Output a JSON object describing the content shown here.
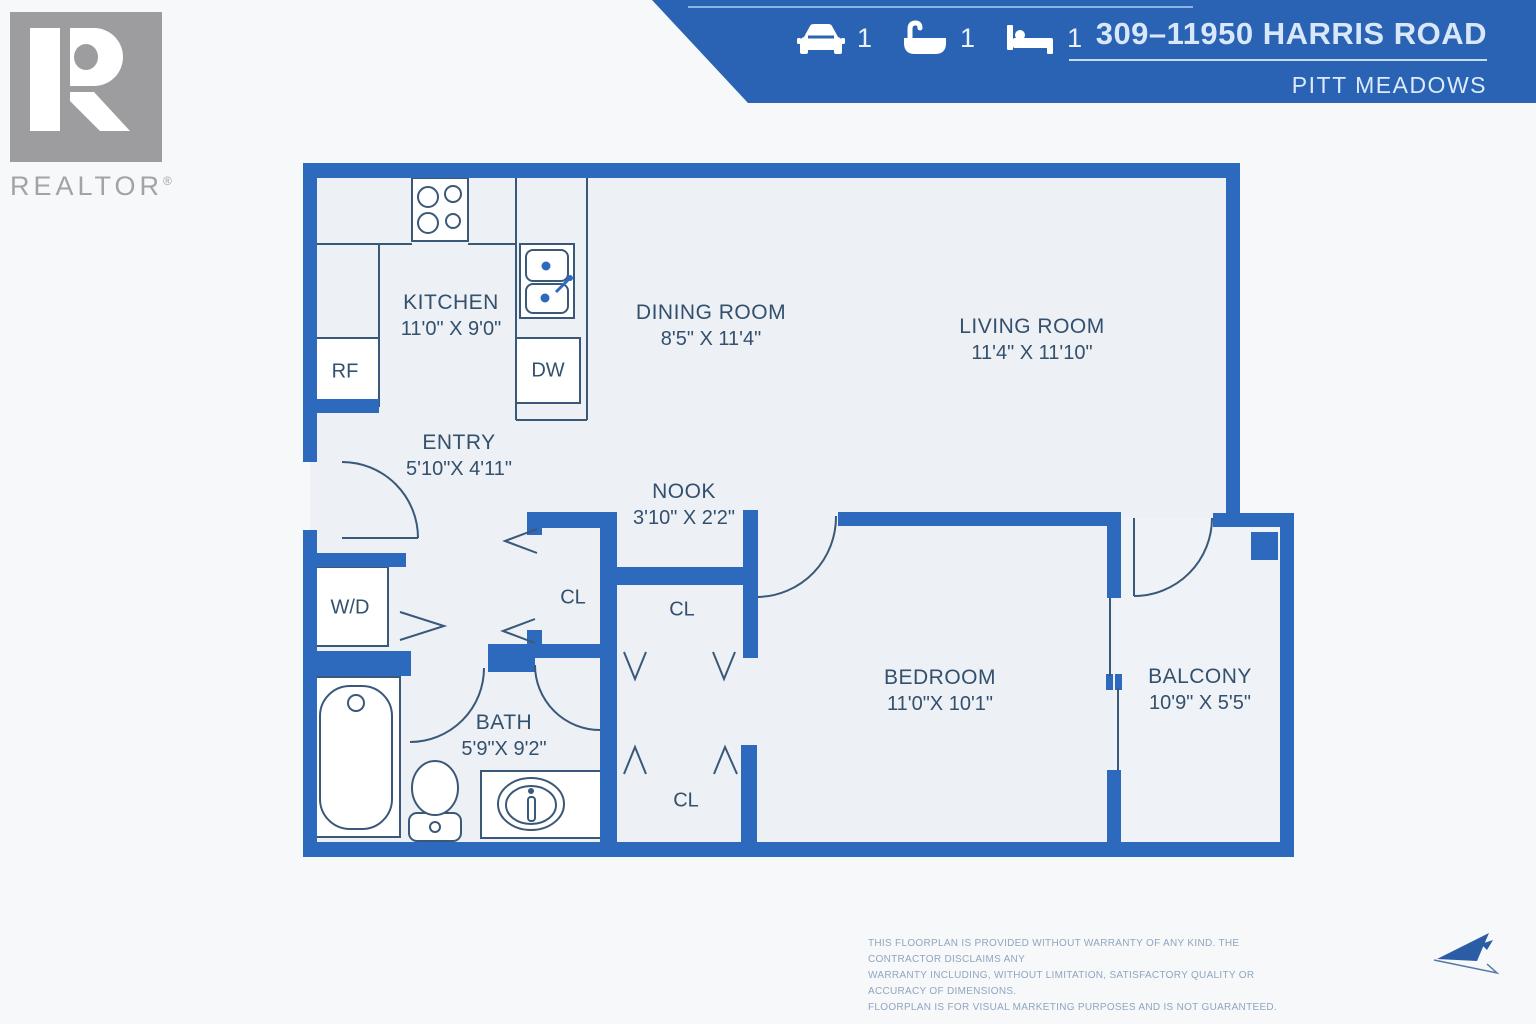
{
  "header": {
    "address": "309–11950 HARRIS ROAD",
    "city": "PITT MEADOWS",
    "stats": {
      "parking": {
        "icon": "car-icon",
        "value": "1"
      },
      "bathrooms": {
        "icon": "bathtub-icon",
        "value": "1"
      },
      "bedrooms": {
        "icon": "bed-icon",
        "value": "1"
      }
    }
  },
  "branding": {
    "realtor_label": "REALTOR",
    "registered_mark": "®"
  },
  "floorplan": {
    "rooms": {
      "kitchen": {
        "name": "KITCHEN",
        "dims": "11'0\" X 9'0\""
      },
      "dining": {
        "name": "DINING ROOM",
        "dims": "8'5\" X 11'4\""
      },
      "living": {
        "name": "LIVING ROOM",
        "dims": "11'4\" X 11'10\""
      },
      "entry": {
        "name": "ENTRY",
        "dims": "5'10\"X 4'11\""
      },
      "nook": {
        "name": "NOOK",
        "dims": "3'10\" X 2'2\""
      },
      "bedroom": {
        "name": "BEDROOM",
        "dims": "11'0\"X 10'1\""
      },
      "balcony": {
        "name": "BALCONY",
        "dims": "10'9\" X 5'5\""
      },
      "bath": {
        "name": "BATH",
        "dims": "5'9\"X 9'2\""
      }
    },
    "fixtures": {
      "fridge": "RF",
      "dishwasher": "DW",
      "washer_dryer": "W/D",
      "closet": "CL"
    }
  },
  "footer": {
    "disclaimer_lines": [
      "THIS FLOORPLAN IS PROVIDED WITHOUT WARRANTY OF ANY KIND. THE CONTRACTOR DISCLAIMS ANY",
      "WARRANTY INCLUDING, WITHOUT LIMITATION, SATISFACTORY QUALITY OR ACCURACY OF DIMENSIONS.",
      "FLOORPLAN IS FOR VISUAL MARKETING PURPOSES AND IS NOT GUARANTEED."
    ]
  },
  "colors": {
    "banner_blue": "#2b63b4",
    "wall_blue": "#2d6abd",
    "floor_fill": "#edf0f5",
    "label_navy": "#33506d",
    "line_dark": "#3a5877",
    "logo_gray": "#9d9d9f",
    "disclaimer_blue": "#8fa6c0"
  }
}
